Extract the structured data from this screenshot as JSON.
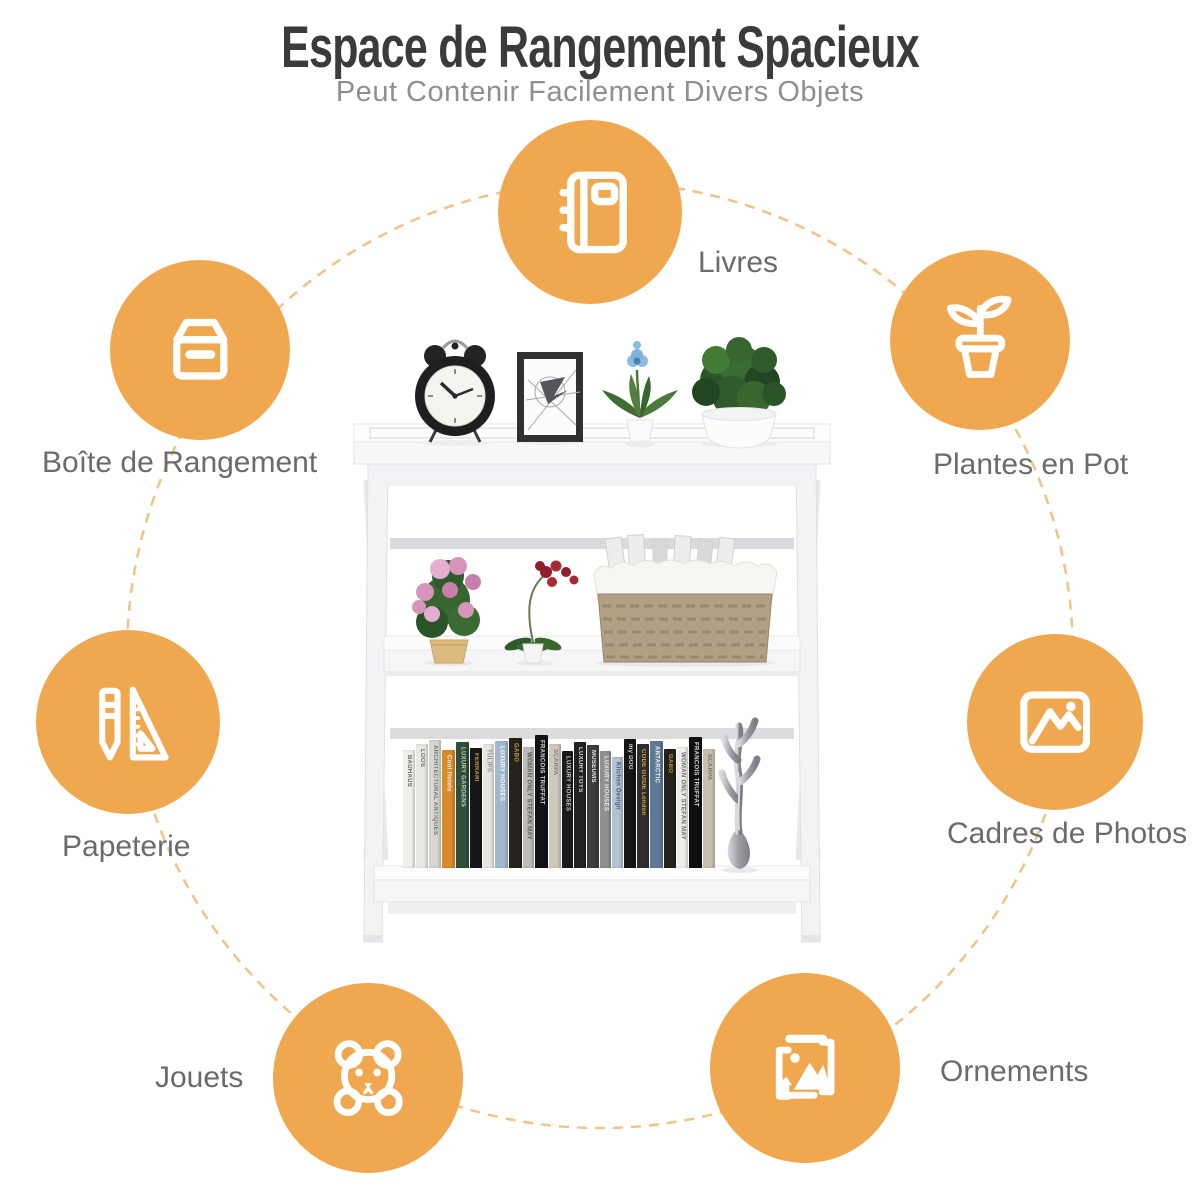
{
  "header": {
    "title": "Espace de Rangement Spacieux",
    "subtitle": "Peut Contenir Facilement Divers Objets"
  },
  "theme": {
    "accent_orange": "#F0A850",
    "dashed_ring": "#EEC488",
    "title_color": "#3B3B3D",
    "subtitle_color": "#8E8F92",
    "label_color": "#6A6B6D",
    "icon_color": "#FFFFFF"
  },
  "features": [
    {
      "id": "livres",
      "label": "Livres",
      "icon": "book-icon"
    },
    {
      "id": "boite",
      "label": "Boîte de Rangement",
      "icon": "storage-box-icon"
    },
    {
      "id": "plantes",
      "label": "Plantes en Pot",
      "icon": "potted-plant-icon"
    },
    {
      "id": "papeterie",
      "label": "Papeterie",
      "icon": "stationery-icon"
    },
    {
      "id": "cadres",
      "label": "Cadres de Photos",
      "icon": "photo-frame-icon"
    },
    {
      "id": "jouets",
      "label": "Jouets",
      "icon": "teddy-bear-icon"
    },
    {
      "id": "ornements",
      "label": "Ornements",
      "icon": "ornament-icon"
    }
  ],
  "product": {
    "books": [
      {
        "title": "BAUHAUS",
        "color": "#f0efeb",
        "text": "#55534e",
        "w": 12,
        "h": 118
      },
      {
        "title": "LOOS",
        "color": "#e9e8e4",
        "text": "#605e59",
        "w": 12,
        "h": 124
      },
      {
        "title": "ARCHITECTURAL ANTIQUES",
        "color": "#d7d6d2",
        "text": "#6b6965",
        "w": 12,
        "h": 128
      },
      {
        "title": "Cool Hotels",
        "color": "#d98a2b",
        "text": "#ffffff",
        "w": 13,
        "h": 118
      },
      {
        "title": "LUXURY GARDENS",
        "color": "#2f4f3a",
        "text": "#cfd8c8",
        "w": 13,
        "h": 126
      },
      {
        "title": "FERRARI",
        "color": "#17171a",
        "text": "#d4af4e",
        "w": 12,
        "h": 120
      },
      {
        "title": "TULIPS",
        "color": "#e7e5df",
        "text": "#8a8880",
        "w": 11,
        "h": 124
      },
      {
        "title": "LUXURY HOUSES",
        "color": "#a3b8cf",
        "text": "#ffffff",
        "w": 13,
        "h": 127
      },
      {
        "title": "GABO",
        "color": "#26231d",
        "text": "#c9a84c",
        "w": 13,
        "h": 130
      },
      {
        "title": "WOMAN ONLY STEFAN MAY",
        "color": "#bcbcb8",
        "text": "#4a4a46",
        "w": 11,
        "h": 121
      },
      {
        "title": "FRANCOIS TRUFFAT",
        "color": "#121214",
        "text": "#e8e8e8",
        "w": 13,
        "h": 133
      },
      {
        "title": "SCARPA",
        "color": "#d0c9ba",
        "text": "#7b7468",
        "w": 12,
        "h": 124
      },
      {
        "title": "LUXURY HOUSES",
        "color": "#1a1a1c",
        "text": "#d8d8d8",
        "w": 11,
        "h": 117
      },
      {
        "title": "LUXURY TOYS",
        "color": "#222225",
        "text": "#e4e4e4",
        "w": 12,
        "h": 126
      },
      {
        "title": "MUSEUMS",
        "color": "#3d3d40",
        "text": "#ffffff",
        "w": 12,
        "h": 123
      },
      {
        "title": "LUXURY HOUSES",
        "color": "#90908e",
        "text": "#f0f0ee",
        "w": 11,
        "h": 117
      },
      {
        "title": "Kitchen Design",
        "color": "#b3c2d4",
        "text": "#3f546b",
        "w": 11,
        "h": 111
      },
      {
        "title": "my DOG",
        "color": "#161618",
        "text": "#e8e8e8",
        "w": 12,
        "h": 129
      },
      {
        "title": "CODE GUIDE London",
        "color": "#2e2e31",
        "text": "#e2b23a",
        "w": 12,
        "h": 124
      },
      {
        "title": "ANTARCTIC",
        "color": "#5e7a97",
        "text": "#ffffff",
        "w": 13,
        "h": 127
      },
      {
        "title": "GABO",
        "color": "#25221c",
        "text": "#c9a84c",
        "w": 12,
        "h": 119
      },
      {
        "title": "WOMAN ONLY STEFAN MAY",
        "color": "#efeeea",
        "text": "#5a5a56",
        "w": 11,
        "h": 121
      },
      {
        "title": "FRANCOIS TRUFFAT",
        "color": "#101012",
        "text": "#ececec",
        "w": 13,
        "h": 131
      },
      {
        "title": "SCARPA",
        "color": "#c9bfae",
        "text": "#6e675c",
        "w": 12,
        "h": 119
      }
    ]
  }
}
